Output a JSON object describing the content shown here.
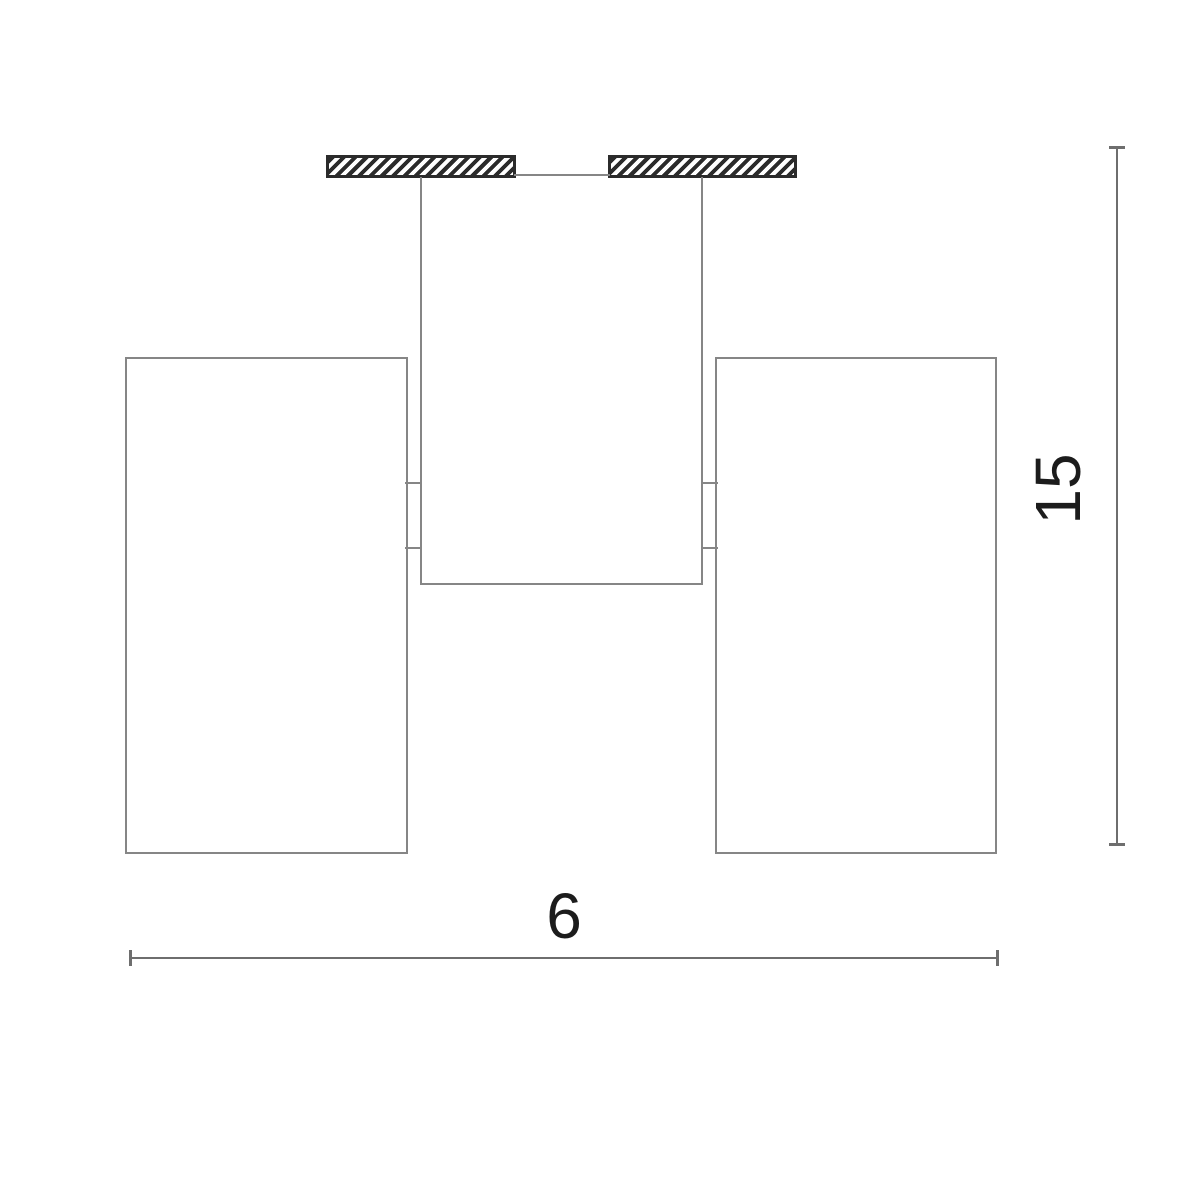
{
  "drawing": {
    "width_dimension": {
      "label": "6",
      "orientation": "horizontal"
    },
    "height_dimension": {
      "label": "15",
      "orientation": "vertical"
    }
  },
  "colors": {
    "background": "#ffffff",
    "outline": "#868686",
    "dimension": "#6e6e6e",
    "hatch": "#2b2b2b",
    "label_text": "#1c1c1c"
  }
}
